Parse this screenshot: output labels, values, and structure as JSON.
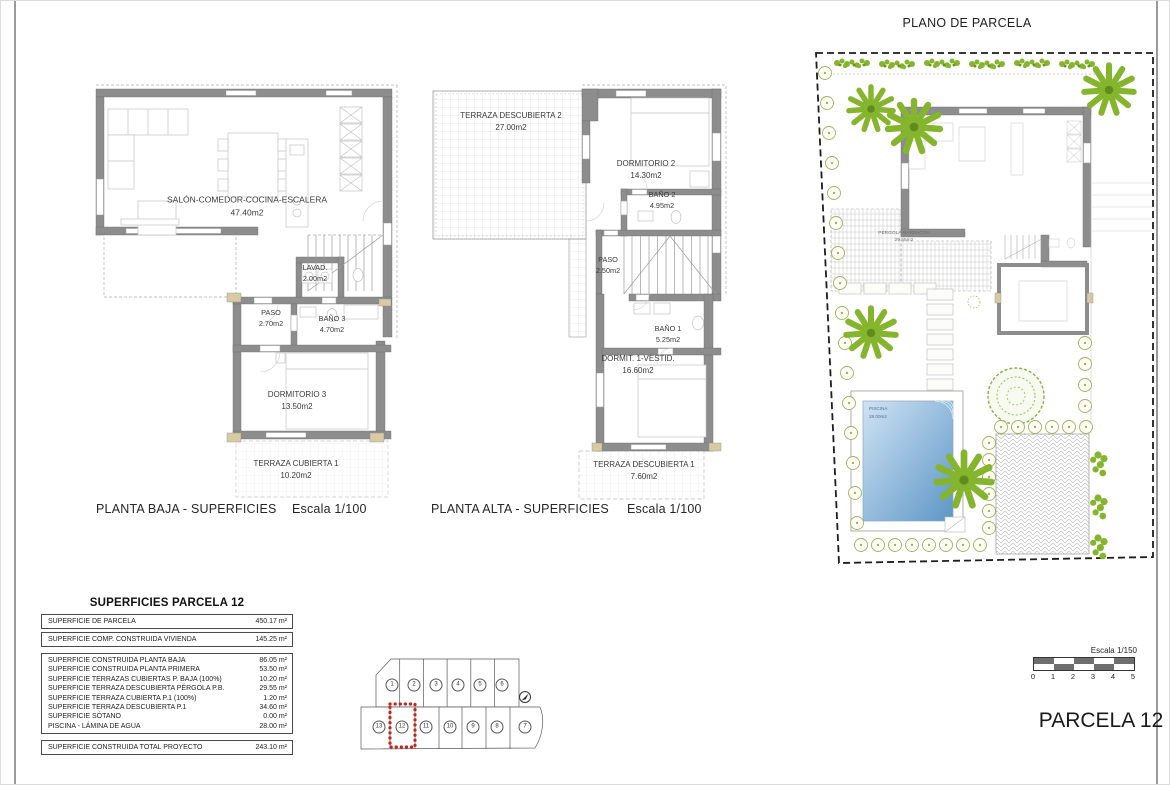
{
  "colors": {
    "wall": "#8d8d8d",
    "tan": "#d8cba4",
    "palmgreen": "#85b52d",
    "bushgreen": "#9cb45c",
    "poollight": "#cfe3f4",
    "pooldark": "#5e96c6",
    "highlightred": "#c4251b"
  },
  "parcela_label": "PARCELA 12",
  "plans": {
    "baja": {
      "caption": "PLANTA BAJA - SUPERFICIES",
      "scale": "Escala 1/100",
      "rooms": [
        {
          "name": "SALÓN-COMEDOR-COCINA-ESCALERA",
          "area": "47.40m2"
        },
        {
          "name": "LAVAD.",
          "area": "2.00m2"
        },
        {
          "name": "PASO",
          "area": "2.70m2"
        },
        {
          "name": "BAÑO 3",
          "area": "4.70m2"
        },
        {
          "name": "DORMITORIO 3",
          "area": "13.50m2"
        },
        {
          "name": "TERRAZA CUBIERTA 1",
          "area": "10.20m2"
        }
      ]
    },
    "alta": {
      "caption": "PLANTA ALTA - SUPERFICIES",
      "scale": "Escala 1/100",
      "rooms": [
        {
          "name": "TERRAZA DESCUBIERTA 2",
          "area": "27.00m2"
        },
        {
          "name": "DORMITORIO 2",
          "area": "14.30m2"
        },
        {
          "name": "BAÑO 2",
          "area": "4.95m2"
        },
        {
          "name": "PASO",
          "area": "2.50m2"
        },
        {
          "name": "BAÑO 1",
          "area": "5.25m2"
        },
        {
          "name": "DORMIT. 1-VESTID.",
          "area": "16.60m2"
        },
        {
          "name": "TERRAZA DESCUBIERTA 1",
          "area": "7.60m2"
        }
      ]
    },
    "site": {
      "title": "PLANO DE PARCELA",
      "pergola": {
        "name": "PÉRGOLA-BARBACOA",
        "area": "29.55m2"
      },
      "pool": {
        "name": "PISCINA",
        "area": "28.00m2"
      }
    }
  },
  "areas_table": {
    "title": "SUPERFICIES PARCELA 12",
    "group1": [
      {
        "label": "SUPERFICIE DE PARCELA",
        "value": "450.17 m²"
      },
      {
        "label": "SUPERFICIE COMP. CONSTRUIDA VIVIENDA",
        "value": "145.25 m²"
      }
    ],
    "group2": [
      {
        "label": "SUPERFICIE CONSTRUIDA PLANTA BAJA",
        "value": "86.05 m²"
      },
      {
        "label": "SUPERFICIE CONSTRUIDA PLANTA PRIMERA",
        "value": "53.50 m²"
      },
      {
        "label": "SUPERFICIE TERRAZAS CUBIERTAS P. BAJA (100%)",
        "value": "10.20 m²"
      },
      {
        "label": "SUPERFICIE TERRAZA DESCUBIERTA PÉRGOLA P.B.",
        "value": "29.55 m²"
      },
      {
        "label": "SUPERFICIE TERRAZA CUBIERTA P.1 (100%)",
        "value": "1.20 m²"
      },
      {
        "label": "SUPERFICIE TERRAZA DESCUBIERTA P.1",
        "value": "34.60 m²"
      },
      {
        "label": "SUPERFICIE SÓTANO",
        "value": "0.00 m²"
      },
      {
        "label": "PISCINA - LÁMINA DE AGUA",
        "value": "28.00 m²"
      }
    ],
    "total": {
      "label": "SUPERFICIE CONSTRUIDA TOTAL PROYECTO",
      "value": "243.10 m²"
    }
  },
  "key_plan": {
    "top_row": [
      "1",
      "2",
      "3",
      "4",
      "5",
      "6"
    ],
    "bottom_row": [
      "13",
      "12",
      "11",
      "10",
      "9",
      "8",
      "7"
    ],
    "highlighted_parcel": "12"
  },
  "scale_bar": {
    "label": "Escala 1/150",
    "ticks": [
      "0",
      "1",
      "2",
      "3",
      "4",
      "5"
    ]
  }
}
